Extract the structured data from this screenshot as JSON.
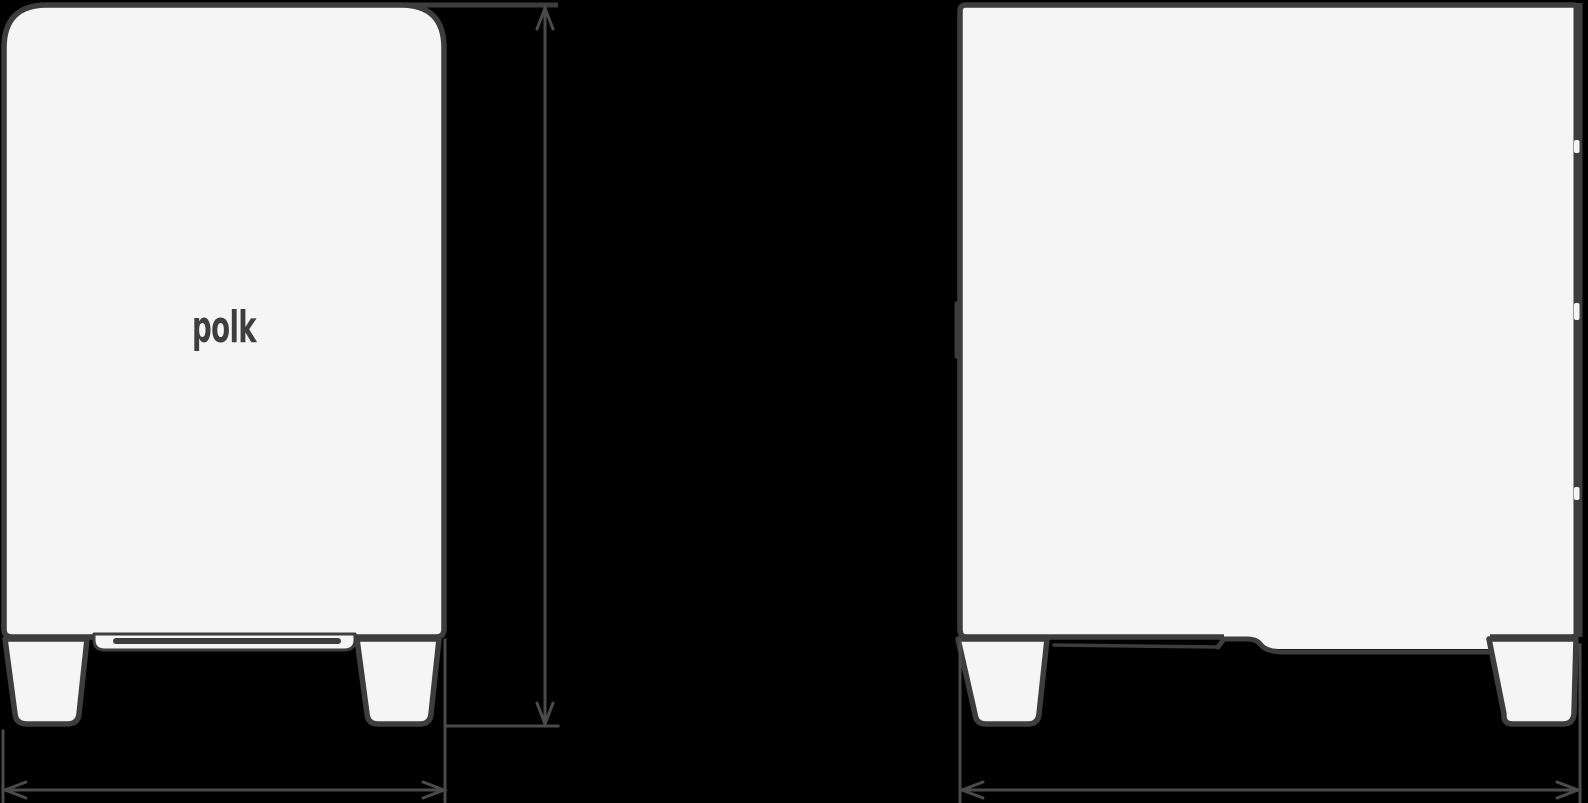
{
  "colors": {
    "background": "#000000",
    "cabinet_fill": "#f5f5f5",
    "cabinet_outline": "#3d3d3d",
    "dimension_line": "#4a4a4a",
    "logo": "#3e3e3e"
  },
  "front_view": {
    "logo_text": "polk"
  }
}
